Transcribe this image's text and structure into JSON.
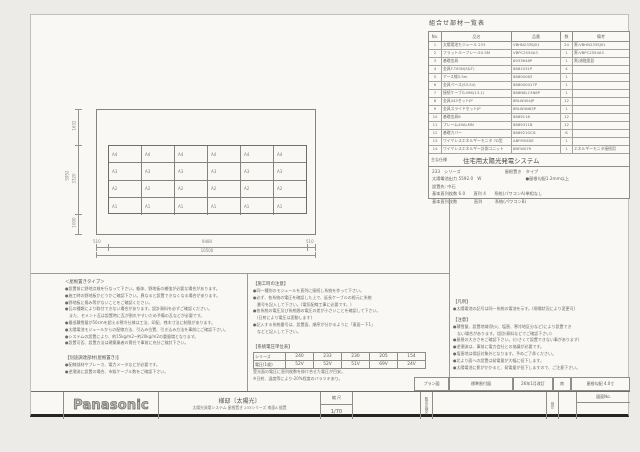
{
  "palette": {
    "paper": "#f9f8f5",
    "line": "#85847f",
    "text": "#5c5b57",
    "heavy_rule": "#26251f"
  },
  "parts_table": {
    "title": "組合せ部材一覧表",
    "headers": [
      "No.",
      "品名",
      "品番",
      "数",
      "備考"
    ],
    "rows": [
      {
        "no": "1",
        "name": "太陽電池モジュール 233",
        "code": "VBHN233SJ01",
        "qty": "24",
        "note": "黒:VBHN233SJ01"
      },
      {
        "no": "2",
        "name": "フラットルーフレール5.5M",
        "code": "VBPC2554A3",
        "qty": "1",
        "note": "黒:VBPC2554A3"
      },
      {
        "no": "3",
        "name": "基礎金具",
        "code": "8933648P",
        "qty": "1",
        "note": "黒/溶融亜鉛"
      },
      {
        "no": "4",
        "name": "金具F-T63N(S&T)",
        "code": "8881031P",
        "qty": "4",
        "note": ""
      },
      {
        "no": "5",
        "name": "アース線3.5m",
        "code": "88800063",
        "qty": "1",
        "note": ""
      },
      {
        "no": "6",
        "name": "金具ベース(S3,S4)",
        "code": "888000417P",
        "qty": "1",
        "note": ""
      },
      {
        "no": "7",
        "name": "接続ケーブル496(13-1)",
        "code": "888N8L13N8P",
        "qty": "1",
        "note": ""
      },
      {
        "no": "8",
        "name": "金具443セットJP",
        "code": "8RLW404JP",
        "qty": "12",
        "note": ""
      },
      {
        "no": "9",
        "name": "金具スライドセットJP",
        "code": "8RLW4N63P",
        "qty": "1",
        "note": ""
      },
      {
        "no": "10",
        "name": "基礎金具B",
        "code": "8889116",
        "qty": "12",
        "note": ""
      },
      {
        "no": "11",
        "name": "フレーム49ALMN",
        "code": "8889311B",
        "qty": "12",
        "note": ""
      },
      {
        "no": "12",
        "name": "基礎カバー",
        "code": "888921GC8",
        "qty": "8",
        "note": ""
      },
      {
        "no": "13",
        "name": "ワイヤレスエネルギーモニタ 7D型",
        "code": "ABFM05DE",
        "qty": "1",
        "note": ""
      },
      {
        "no": "14",
        "name": "ワイヤレスエネルギー計測ユニット",
        "code": "8BFW079",
        "qty": "1",
        "note": "エネルギーモニタ接続用"
      }
    ]
  },
  "spec": {
    "label": "主な仕様",
    "system": "住宅用太陽光発電システム",
    "series": "233　シリーズ",
    "type": "屋根置き　タイプ",
    "output": "太陽電池出力 5592.0　W",
    "output_note": "●屋根勾配1.2mm以上",
    "dest": "設置先: 中石",
    "line_a": "基本直列枚数 6.0　　直列 4　　系統(パワコンA)単相なし",
    "line_b": "基本直列枚数　　　　直列　　　系統(パワコンB)"
  },
  "drawing": {
    "row_labels": [
      "A4",
      "A3",
      "A2",
      "A1"
    ],
    "cols": 6,
    "dim_v_top": "1632",
    "dim_v_mid": "3320",
    "dim_v_total": "5952",
    "dim_v_bottom": "1000",
    "dim_h_left": "510",
    "dim_h_center": "9480",
    "dim_h_right": "510",
    "dim_h_total": "10500"
  },
  "notes_left": {
    "title": "＜屋根置きタイプ＞",
    "items": [
      "●設置前に野地点検を行なって下さい。躯体、野地板の補強が必要な場合があります。",
      "●施工時の野地板かどうかご確認下さい。異なると設置できなくなる場合があります。",
      "●野地板に傷み等がないことをご確認ください。",
      "●瓦の種類により取付できない場合があります。設計資料を必ずご確認ください。",
      "　また、セメント瓦は設置時に瓦が割れやすいため予備の瓦などが必要です。",
      "●最低積雪量が50cmを超える寒冷仕様は工法、印配、桟木寸法に制限があります。",
      "●太陽電池モジュールからの配線方法、引込み位置、引き込み方法を事前にご確認下さい。",
      "●システムの設置により、約15kg/m2~約20kg/m2の重量増となります。",
      "●設置可否、設置方法は建築業者の責任で事前に充分ご検討下さい。"
    ]
  },
  "notes_left2": {
    "title": "【別途調達部材(屋根置き)】",
    "items": [
      "●配線部材やブレーカ、電力メータなどが必要です。",
      "●逆潮流に設置の場合、市販ケーブル数をご確認下さい。"
    ]
  },
  "notes_mid": {
    "title": "【施工時の注意】",
    "items": [
      "●同一種別のモジュールを直列に接続し系統を作って下さい。",
      "●必ず、各系統の電圧を確認した上で、延長ケーブルの根元に系統",
      "　番号を記入して下さい。(電気配線工事に必要です。)",
      "●各系統の電圧及び系統間の電圧の差が小さいことを確認して下さい。",
      "　(日射により電圧は変動します)",
      "●記入する系統番号は、設置面、順序が分かるように「東面一下1」",
      "　などと記入して下さい。"
    ]
  },
  "voltage_table": {
    "title": "【系統電圧単位表】",
    "row1_label": "シリーズ",
    "row2_label": "電圧(1枚)",
    "series": [
      "240",
      "233",
      "230",
      "205",
      "154"
    ],
    "volts": [
      "52V",
      "52V",
      "51V",
      "69V",
      "24V"
    ],
    "notes": [
      "受光面の電圧に直列枚数を掛け合せた電圧が目安。",
      "※日射、温度等により-20%程度のバラツキあり。"
    ]
  },
  "notes_right": {
    "legend_title": "【凡例】",
    "legend_items": [
      "●太陽電池の記号は同一系統の電池を示す。(現場状況により変更可)"
    ],
    "caution_title": "【注意】",
    "items": [
      "●積雪量、設置地域(防火、塩害、寒冷地区分など)により設置でき",
      "　ない場合があります。(設計資料などでご確認下さい)",
      "●屋根の大きさをご確認下さい。(小さくて設置できない事があります)",
      "●逆潮流は、事前に電力会社との協議が必要です。",
      "●塩害地は保証対象外となります。予めご了承ください。",
      "●北より面への設置は発電量が大幅に低下します。",
      "●太陽電池に影がかかると、発電量が低下しますので、ご注意下さい。"
    ]
  },
  "titleblock": {
    "toprow": [
      "プラン図",
      "標準割付図",
      "26年1月改訂",
      "南",
      "屋根勾配 4.0寸"
    ],
    "logo": "Panasonic",
    "title": "様邸〔太陽光〕",
    "subtitle": "太陽光発電システム 屋根置き 233シリーズ 南面A 据置",
    "scale_label": "縮 尺",
    "scale_value": "1/70",
    "dealer_label": "販売店様名",
    "stamp_label": "検印",
    "figno_label": "図面No."
  }
}
